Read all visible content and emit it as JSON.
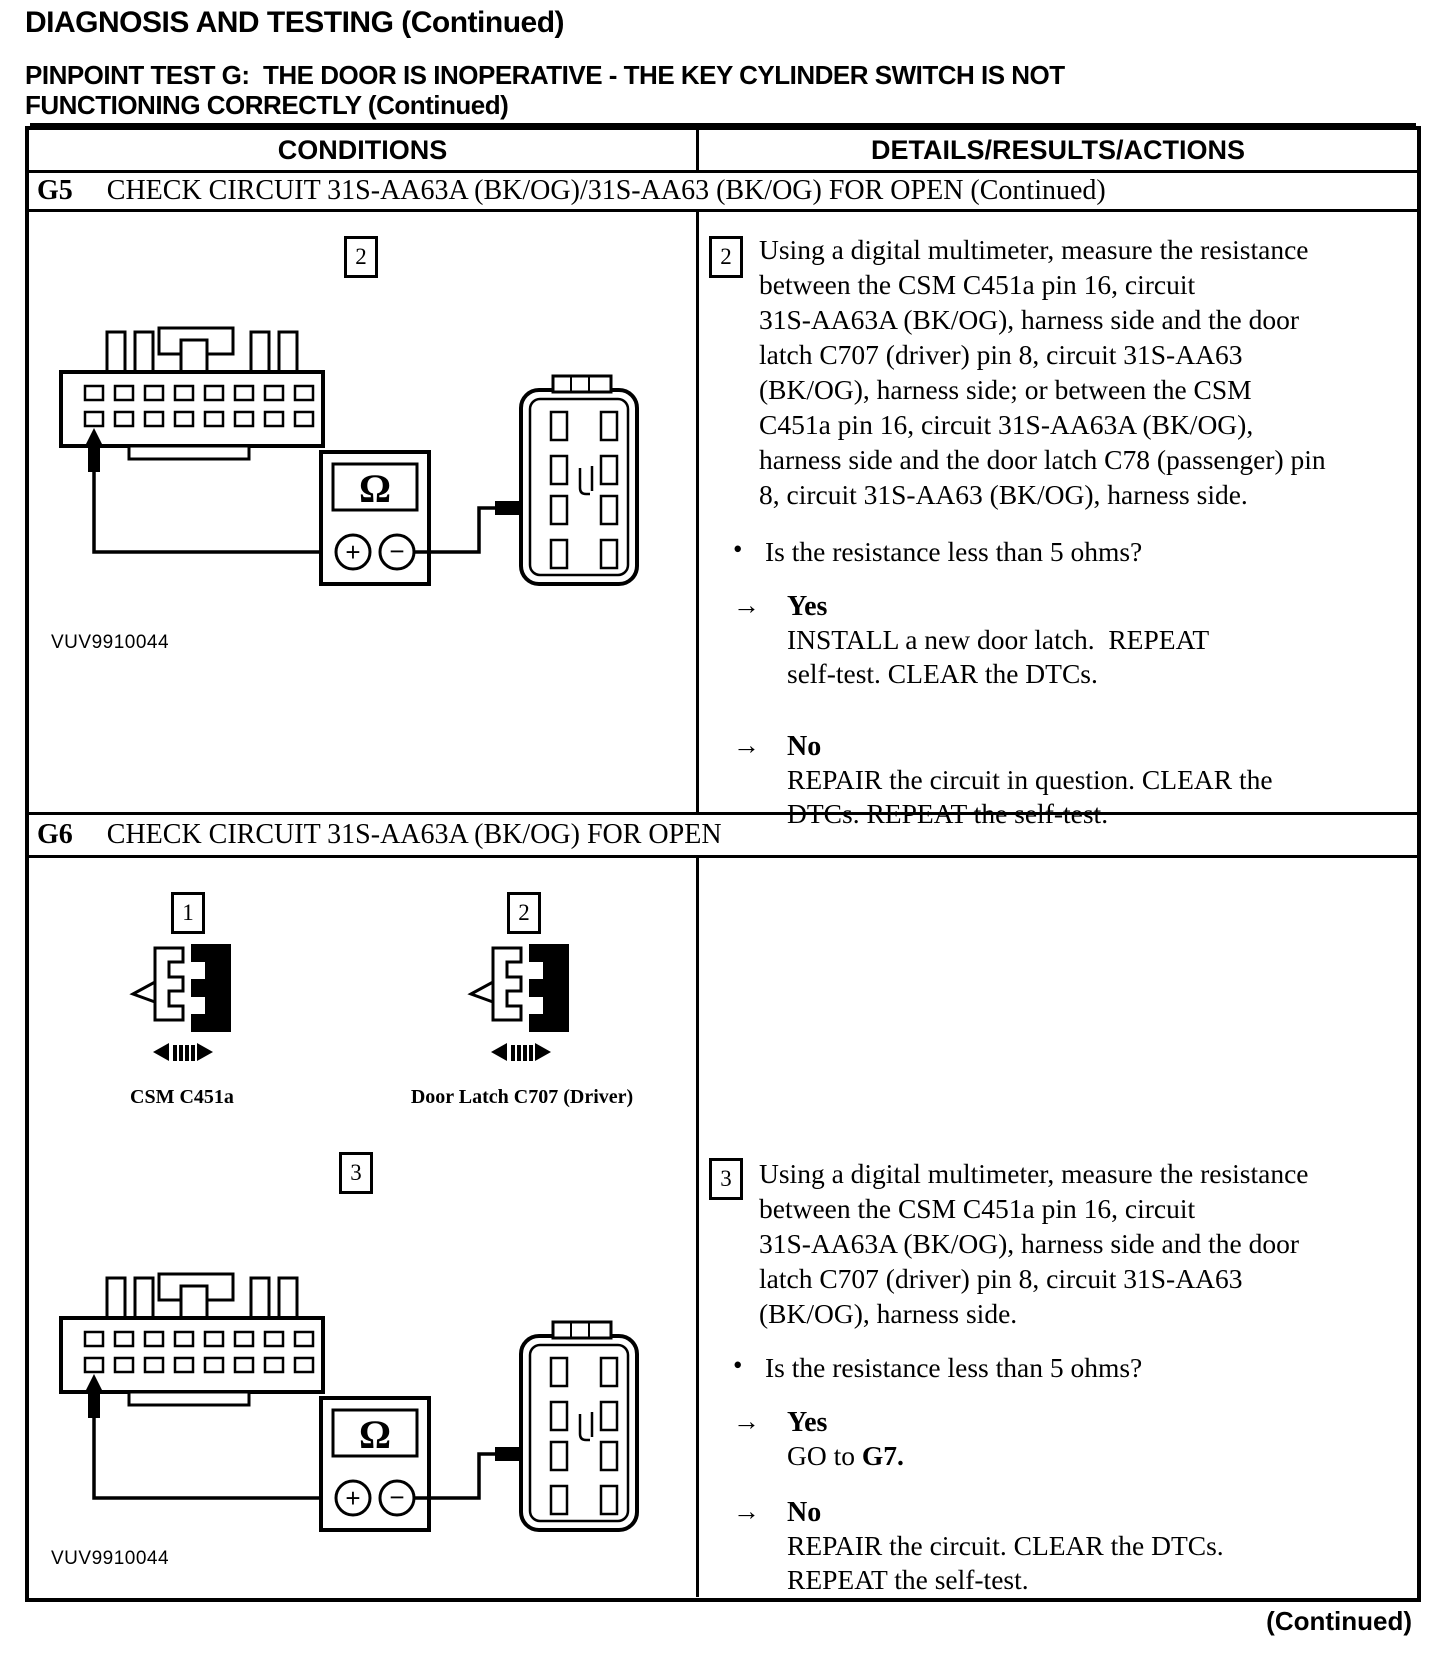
{
  "page": {
    "title": "DIAGNOSIS AND TESTING (Continued)",
    "subtitle_lines": [
      "PINPOINT TEST G:  THE DOOR IS INOPERATIVE - THE KEY CYLINDER SWITCH IS NOT",
      "FUNCTIONING CORRECTLY (Continued)"
    ],
    "footer_continued": "(Continued)"
  },
  "icons": {
    "arrow_right": "→",
    "bullet": "•"
  },
  "meter": {
    "ohm": "Ω",
    "plus": "+",
    "minus": "−"
  },
  "table": {
    "header": {
      "conditions": "CONDITIONS",
      "details": "DETAILS/RESULTS/ACTIONS"
    },
    "g5": {
      "id": "G5",
      "title": "CHECK CIRCUIT 31S-AA63A (BK/OG)/31S-AA63 (BK/OG) FOR OPEN (Continued)",
      "figure": {
        "step_no": "2",
        "caption": "VUV9910044"
      },
      "step": {
        "number": "2",
        "lines": [
          "Using a digital multimeter, measure the resistance",
          "between the CSM C451a pin 16, circuit",
          "31S-AA63A (BK/OG), harness side and the door",
          "latch C707 (driver) pin 8, circuit 31S-AA63",
          "(BK/OG), harness side; or between the CSM",
          "C451a pin 16, circuit 31S-AA63A (BK/OG),",
          "harness side and the door latch C78 (passenger) pin",
          "8, circuit 31S-AA63 (BK/OG), harness side."
        ],
        "question": "Is the resistance less than 5 ohms?",
        "yes_label": "Yes",
        "yes_lines": [
          "INSTALL a new door latch.  REPEAT",
          "self-test. CLEAR the DTCs."
        ],
        "no_label": "No",
        "no_lines": [
          "REPAIR the circuit in question. CLEAR the",
          "DTCs. REPEAT the self-test."
        ]
      }
    },
    "g6": {
      "id": "G6",
      "title": "CHECK CIRCUIT 31S-AA63A (BK/OG) FOR OPEN",
      "connectors": [
        {
          "step_no": "1",
          "label": "CSM C451a"
        },
        {
          "step_no": "2",
          "label": "Door Latch C707 (Driver)"
        }
      ],
      "figure": {
        "step_no": "3",
        "caption": "VUV9910044"
      },
      "step": {
        "number": "3",
        "lines": [
          "Using a digital multimeter, measure the resistance",
          "between the CSM C451a pin 16, circuit",
          "31S-AA63A (BK/OG), harness side and the door",
          "latch C707 (driver) pin 8, circuit 31S-AA63",
          "(BK/OG), harness side."
        ],
        "question": "Is the resistance less than 5 ohms?",
        "yes_label": "Yes",
        "yes_prefix": "GO to ",
        "yes_target": "G7.",
        "no_label": "No",
        "no_lines": [
          "REPAIR the circuit. CLEAR the DTCs.",
          "REPEAT the self-test."
        ]
      }
    }
  }
}
